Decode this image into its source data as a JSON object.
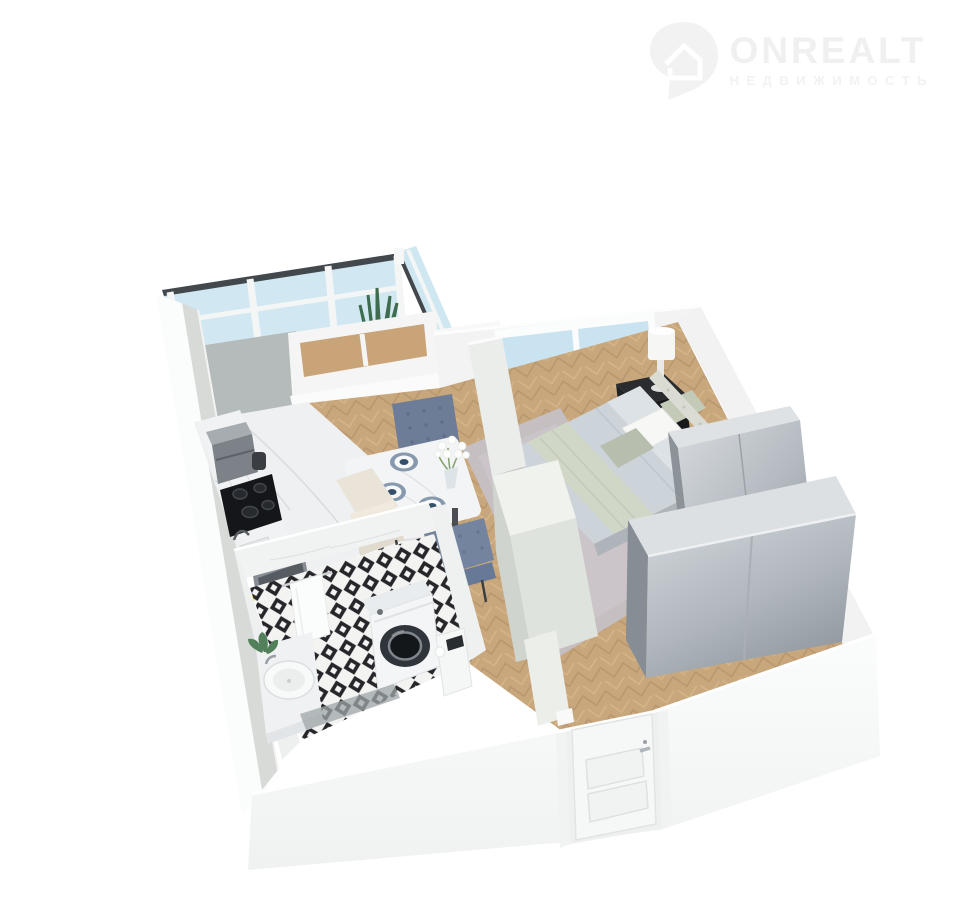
{
  "logo": {
    "brand": "ONREALT",
    "tagline": "НЕДВИЖИМОСТЬ",
    "icon": "house-location-pin-icon",
    "color": "#f0f0f0"
  },
  "scene": {
    "title": "3D isometric floor plan render of a one-room apartment",
    "background": "#ffffff",
    "rooms": [
      {
        "name": "balcony",
        "features": [
          "panoramic glazing",
          "wood floor",
          "snake plant in white pot",
          "small green plant"
        ]
      },
      {
        "name": "kitchen",
        "features": [
          "marble countertop along wall",
          "black 4-burner cooktop",
          "gray oven",
          "coffee machine",
          "sink with faucet",
          "fruit plate",
          "gray accent wall",
          "white marble floor"
        ]
      },
      {
        "name": "dining-area",
        "features": [
          "white marble table",
          "three place settings with blue chargers",
          "vase with white flowers",
          "blue tufted chair",
          "cream chair",
          "blue chair",
          "herringbone oak floor"
        ]
      },
      {
        "name": "bedroom",
        "features": [
          "double bed with gray duvet",
          "sage throw blanket",
          "white and sage pillows",
          "tufted headboard",
          "black nightstand",
          "white table lamp",
          "window",
          "gray rug",
          "small gray wardrobe",
          "large gray two-door wardrobe"
        ]
      },
      {
        "name": "bathroom",
        "features": [
          "marble walls",
          "black-and-white diamond tile floor",
          "washing machine",
          "round white vessel sink",
          "towel on rail",
          "green plant",
          "toilet cabinet",
          "gray mat"
        ]
      },
      {
        "name": "hallway",
        "features": [
          "white panelled entrance door with silver handle",
          "herringbone oak floor"
        ]
      }
    ],
    "palette": {
      "exterior_walls": "#f7f8f8",
      "inner_wall_gray": "#d8dad8",
      "accent_wall": "#b5babb",
      "glass": "#cfe7f1",
      "wood_floor": "#c9a77c",
      "marble": "#eef0f1",
      "wardrobe_metal": "#a7adb3",
      "bed_duvet": "#ccd3d9",
      "blanket_sage": "#d1d7c7",
      "chair_blue": "#74839d",
      "chair_cream": "#e9e3d8",
      "tile_black": "#26262a",
      "rug": "#c5bfc2",
      "nightstand_black": "#1e2023"
    }
  }
}
